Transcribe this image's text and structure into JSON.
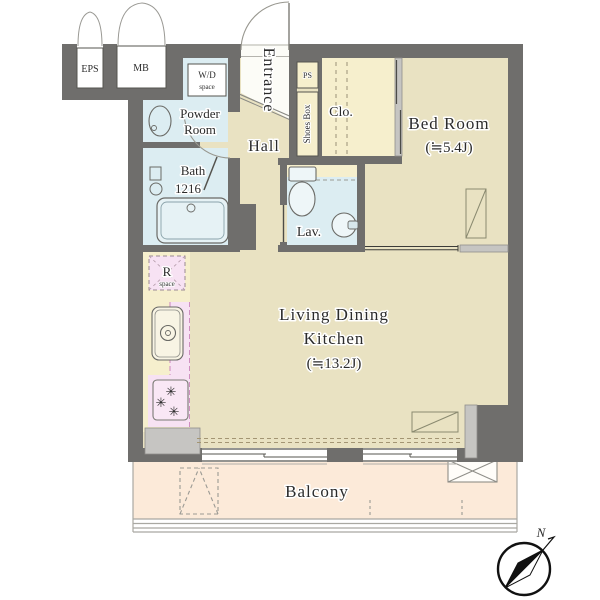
{
  "plan": {
    "rooms": {
      "entrance": {
        "label": "Entrance"
      },
      "hall": {
        "label": "Hall"
      },
      "powder_room": {
        "line1": "Powder",
        "line2": "Room"
      },
      "bath": {
        "line1": "Bath",
        "line2": "1216"
      },
      "lavatory": {
        "label": "Lav."
      },
      "closet": {
        "label": "Clo."
      },
      "shoes_box": {
        "label": "Shoes Box"
      },
      "ps": {
        "label": "PS"
      },
      "wd_space": {
        "line1": "W/D",
        "line2": "space"
      },
      "bedroom": {
        "name": "Bed Room",
        "size": "(≒5.4J)"
      },
      "ldk": {
        "line1": "Living Dining",
        "line2": "Kitchen",
        "size": "(≒13.2J)"
      },
      "r_space": {
        "line1": "R",
        "line2": "space"
      },
      "balcony": {
        "label": "Balcony"
      },
      "eps": {
        "label": "EPS"
      },
      "mb": {
        "label": "MB"
      }
    },
    "compass": {
      "north_label": "N"
    },
    "colors": {
      "wall_dark": "#6f6e6c",
      "wall_light": "#c6c5c2",
      "floor_beige": "#e9e2c2",
      "pale_yellow": "#f6efcd",
      "wet_blue": "#dcedf2",
      "kitchen_pink": "#f7e2f3",
      "balcony_peach": "#fcead9",
      "entrance_white": "#fcfcf7",
      "fixture_outline": "#6a6a66",
      "text": "#2b2b2b",
      "compass_black": "#111111",
      "dashed_pink": "#cf8fc0"
    }
  }
}
